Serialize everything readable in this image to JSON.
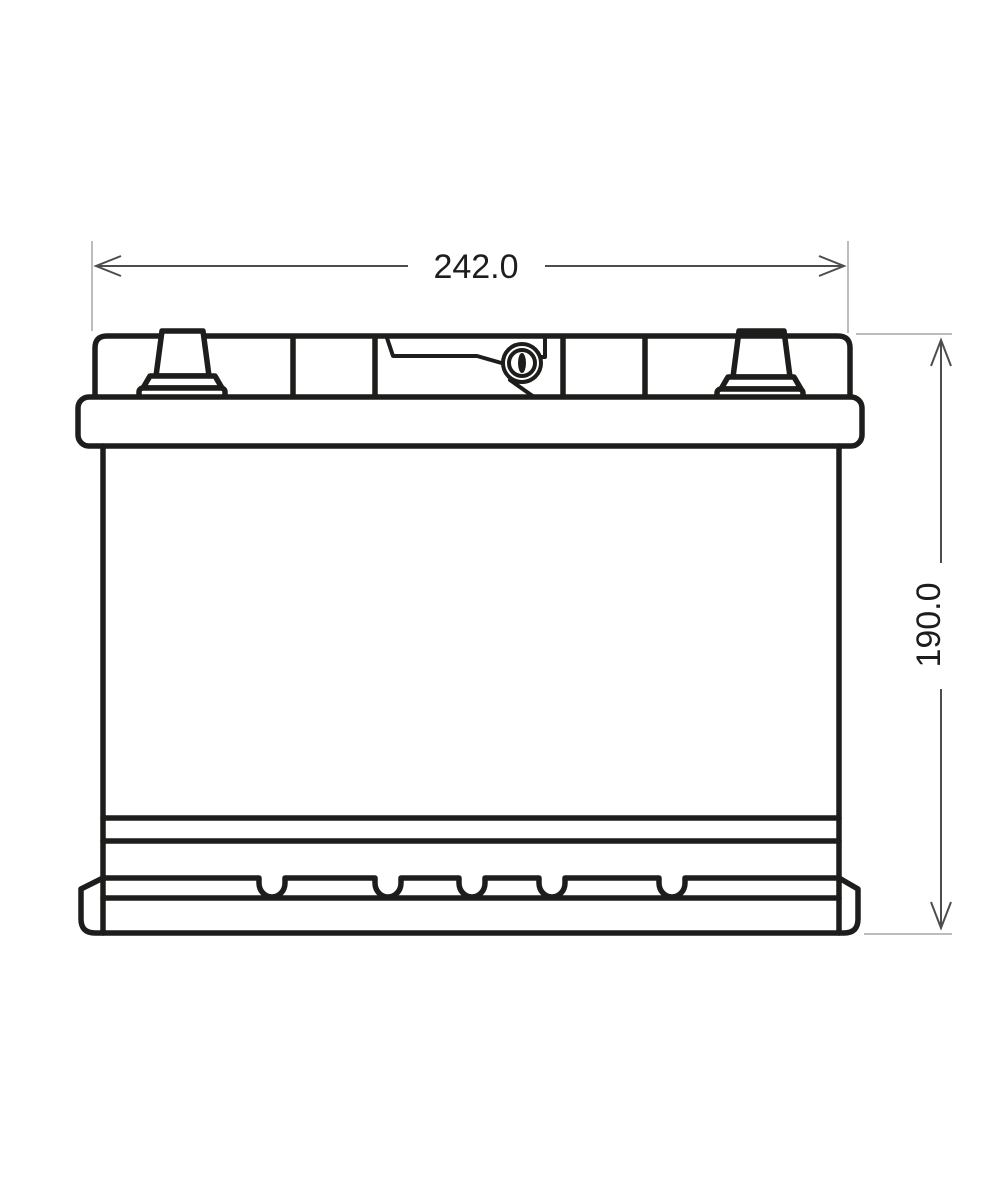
{
  "drawing": {
    "width_label": "242.0",
    "height_label": "190.0"
  },
  "colors": {
    "positive_terminal_fill": "#e3261f",
    "outline": "#1d1d1b",
    "extension_line": "#bdbdbd",
    "dimension_line": "#4d4d4d",
    "background": "#ffffff"
  }
}
